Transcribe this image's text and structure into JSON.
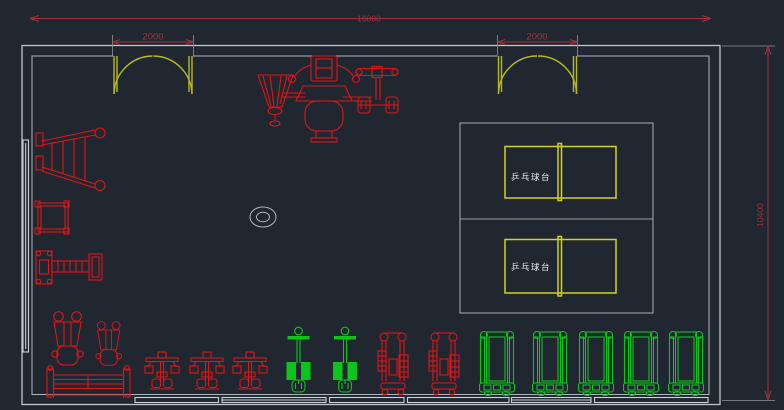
{
  "dimensions": {
    "overall_width": "16800",
    "left_door_width": "2000",
    "right_door_width": "2000",
    "overall_height": "10400"
  },
  "labels": {
    "ping_pong_table_1": "乒乓球台",
    "ping_pong_table_2": "乒乓球台"
  },
  "colors": {
    "background": "#202731",
    "wall_gray": "#c2c6ca",
    "dimension_red": "#a33038",
    "equipment_red": "#e21515",
    "equipment_green": "#0cc41c",
    "door_yellow": "#b8bb1e",
    "table_yellow": "#d2d41a",
    "court_gray": "#9aa2aa",
    "label_white": "#e6e9ec"
  }
}
